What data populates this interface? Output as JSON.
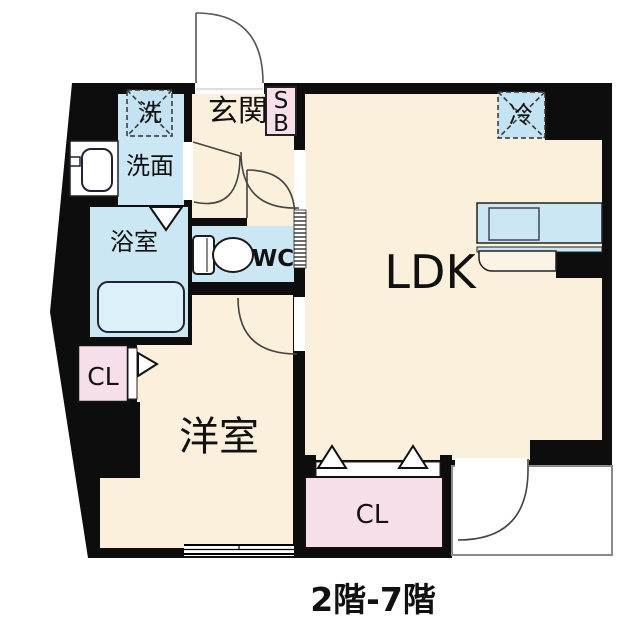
{
  "plan": {
    "caption": "2階-7階",
    "rooms": {
      "entrance": "玄関",
      "shoe_box_line1": "S",
      "shoe_box_line2": "B",
      "washer": "洗",
      "washroom": "洗面",
      "bathroom": "浴室",
      "toilet": "WC",
      "ldk": "LDK",
      "fridge": "冷",
      "closet_left": "CL",
      "closet_bottom": "CL",
      "bedroom": "洋室"
    },
    "colors": {
      "wall_black": "#0d0d0d",
      "floor_cream": "#faf0dc",
      "wet_area_blue": "#cbe7f3",
      "closet_pink": "#f7dfe9",
      "balcony_border_gray": "#8a8a8a"
    }
  }
}
